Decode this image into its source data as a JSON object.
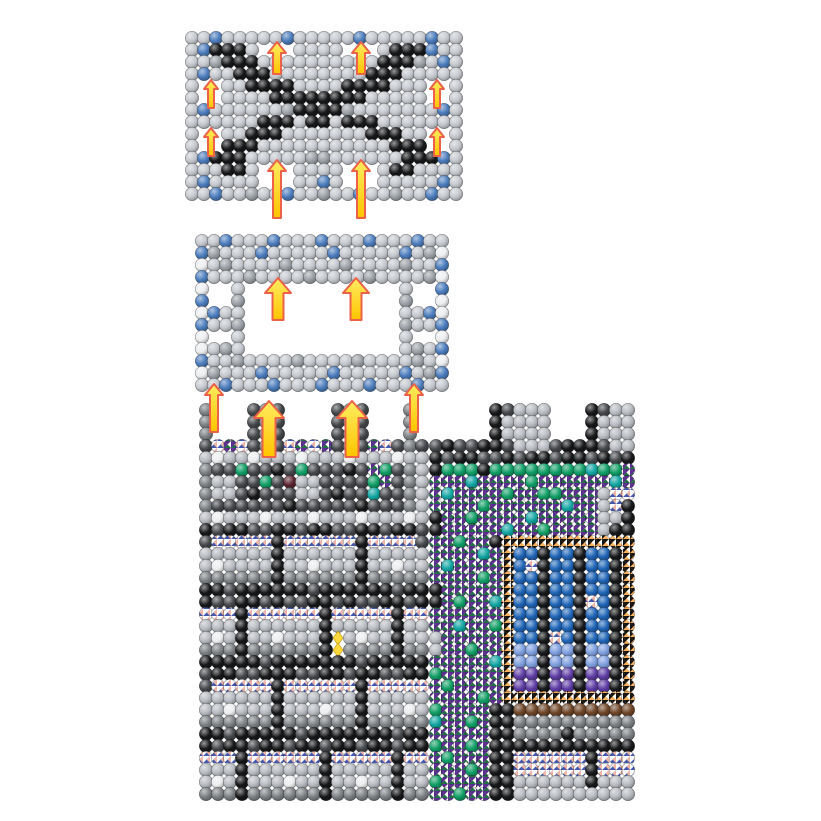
{
  "figure": {
    "kind": "molecular-assembly-exploded-view",
    "background": "#ffffff"
  },
  "scene": {
    "width": 821,
    "height": 821,
    "palette": {
      "S": "#c4c8ce",
      "W": "#eceef0",
      "G": "#9aa0a6",
      "L": "#b7bbc1",
      "M": "#7c8084",
      "D": "#44474b",
      "K": "#17181a",
      "B": "#4b7cbc",
      "E": "#0f9d64",
      "T": "#10a4a1",
      "U": "#1e64b6",
      "u": "#7e9ede",
      "R": "#5e3ca4",
      "N": "#6f4527",
      "x": "#5b2430"
    },
    "patterns": {
      "P": {
        "base": "#7f96da",
        "tris": [
          "#ffffff",
          "#f0b5a4",
          "#4458ac",
          "#ffffff"
        ]
      },
      "V": {
        "base": "#8cc63f",
        "tris": [
          "#5b2d91",
          "#ffffff",
          "#206f45",
          "#5b2d91"
        ]
      },
      "O": {
        "base": "#f68b1f",
        "tris": [
          "#141414",
          "#ffffff",
          "#f9b25f",
          "#141414"
        ]
      }
    },
    "panels": [
      {
        "name": "lid-lattice-panel",
        "x": 186,
        "y": 32,
        "bead": 12,
        "rows": [
          "SSBSSSSSBSSSSSBSSSSSBSS",
          "SBKKKS...SSSS...SKKKBSS",
          "SSGKKKSSSSSSSSSSKKKGSBS",
          "SBSSKKKSSSSSSSSKKKSSSSS",
          "S..SSKKKKSSSSKKKKSSS..S",
          "S..SSSSKKKKKKKKSSSSS..S",
          "SBSSSSSSGKKKKGSSSSSSSBS",
          "SSSSSSKKKSKKSKKKSSSSSSS",
          "S..SSKKKSSSSSSSKKKSS..S",
          "S..KKKSSSSSSSSSSSKKK..S",
          "SBKKKSSSSSGGSSSSSSKKKBS",
          "SSSKKS...SSSS...SKKSSSS",
          "SBSSSS...SSBS...SSSSSBS",
          "SSBSSGSSBSSGSSBSSGSSBSS"
        ]
      },
      {
        "name": "frame-panel",
        "x": 196,
        "y": 235,
        "bead": 12,
        "rows": [
          "SSBSSSBSSSBSSSBSSSBSS",
          "BGSSSBSSSSSBSSSSSBSGW",
          "WSGSSSSGSSSSGSSSSGSSB",
          "BSSSGSSSSGSSSSGSSSSGW",
          "W..S.............S..B",
          "B..G.............G..W",
          "WBSS.............SSBW",
          "BSSG.............GSSB",
          "W..S.............S..W",
          "WSGS.............SGSB",
          "BSSGSSSSGSSSSGSSSSGSW",
          "WGSSSBSSSSSBSSSSSBSGB",
          "SSBSSSBSSSBSSSBSSSBSS"
        ]
      },
      {
        "name": "box-wall-3d",
        "x": 200,
        "y": 404,
        "bead": 12,
        "rows": [
          "M...DMD....DMD...M.",
          "M...DMD....DMD...M.",
          "M...DMD....DMD...M.",
          "DPVPDMDPVPVDMDVPDMD",
          "LWLLWLLLWLLLWLLLWLL",
          "MDDEDDKDEDDDKDVEDML",
          "MLLDDEDxLLDDDDEVDML",
          "MLLDKDDDLLDKDDTDDML",
          "MDDDDDDKDDDDDKDDDML",
          "LWLLLWLLLWLLLWLLLWL",
          "KDKKDDKKDKKDDKKDKKD",
          "DPPPPPKPPPPPPKPPPPD",
          "LLLLLLKLLLLLLKLLLLL",
          "LWLLLLKLLWLLLKLLWLL",
          "MMMMMMKMMMMMMKMMMMM",
          "KKDKKKKKKDKKKKKKDKK",
          "KDDKKDKDDKKDKDDKKDK",
          "PPPKPPPPPPKPPPPPKPP",
          "LLLKLLLLLLKLLLLLKLL",
          "LWLKLLWLLLKYLWLLKLL",
          "MMMKMMMMMMKYMMMMKMM",
          "KKKKKDKKKKKKKDKKKKK",
          "DKKDDKKKDDKKDKKDDKK",
          "DPPPPPKPPPPPPKPPPPP",
          "LLLLLLKLLLLLLKLLLLL",
          "LLWLLLKLLLWLLKLLLWL",
          "MMMMMMKMMMMMMKMMMMM",
          "KKDKKKKKDKKKKKKKDKK",
          "KDKKDKKDKKDKKDKKDKK",
          "PPPKPPPPPPKPPPPPKPP",
          "LLLKLLLLLLKLLLLLKLL",
          "LWLKLLLWLLKLLWLLKLL",
          "MMMKMMMMMMKMMMMMKMM"
        ]
      },
      {
        "name": "cross-section-panel",
        "x": 430,
        "y": 404,
        "bead": 12,
        "rows": [
          ".....KDLLL...KDLL",
          ".....KLLLL...KLLL",
          ".....KLLLL...KLLL",
          "DKDDKKDLLLDKKKDLL",
          "KDKKDDKDKKDKKDKDK",
          "KEEEKEEEEEEEETEEV",
          "VVVTVVVVEVVVVVVTV",
          "VTVVVVEVVEEVVVLPP",
          "VVVVEVVVVVVTVVLPK",
          "KVVEVVVVTVVVVVLLK",
          "KVVVVVTVVEVVVVLKK",
          "VVEVVKOOOOOOOOOOO",
          "VVVVTVOUUKUUKUUKO",
          "VTVVVVOUPKUUKUUKO",
          "VVVVEVOUUKUUKUUKO",
          "KVVVVVOUUKUUKUUKO",
          "KVEVVTOUUKUUKPUKO",
          "VVVVVVOUUKUUKUUKO",
          "VVTVVEOUUKUUKUUKO",
          "LVVVVVOUUKPUKUUKO",
          "LVVEVVOuuKuuKuuKO",
          "VVVVVTOuuKuuKuuKO",
          "EVVVVVORRKRRKRRKO",
          "VEVVVVORRKRRKRRKO",
          "VVVVEVOOOOOOOOOOO",
          "EVVVVKKNNNNNNNNNN",
          "TVVEVKKMMMMMMMMMM",
          "VVVVVKKMMMMKMMMMM",
          "EVVEVKKKKKKKKKKKK",
          "VEVVVKKPPPPPPKPPP",
          "VVVEVKKPPPPPPKPPP",
          "EVVVVKKLLLLLLKLLL",
          "VVEVVKKLLLLLLLLLL"
        ]
      }
    ],
    "arrows": {
      "fill_top": "#ffec60",
      "fill_bottom": "#ffc400",
      "stroke": "#ed6148",
      "sizes": {
        "xsmall": {
          "head_w": 14,
          "head_h": 9,
          "stem_w": 6
        },
        "small": {
          "head_w": 18,
          "head_h": 11,
          "stem_w": 8
        },
        "medium": {
          "head_w": 26,
          "head_h": 15,
          "stem_w": 11
        },
        "large": {
          "head_w": 30,
          "head_h": 17,
          "stem_w": 13
        }
      },
      "items": [
        {
          "cx": 277,
          "tip_y": 42,
          "len": 32,
          "size": "small"
        },
        {
          "cx": 361,
          "tip_y": 42,
          "len": 32,
          "size": "small"
        },
        {
          "cx": 211,
          "tip_y": 80,
          "len": 28,
          "size": "xsmall"
        },
        {
          "cx": 437,
          "tip_y": 80,
          "len": 28,
          "size": "xsmall"
        },
        {
          "cx": 211,
          "tip_y": 128,
          "len": 28,
          "size": "xsmall"
        },
        {
          "cx": 437,
          "tip_y": 128,
          "len": 28,
          "size": "xsmall"
        },
        {
          "cx": 277,
          "tip_y": 160,
          "len": 58,
          "size": "small"
        },
        {
          "cx": 361,
          "tip_y": 160,
          "len": 58,
          "size": "small"
        },
        {
          "cx": 278,
          "tip_y": 278,
          "len": 42,
          "size": "medium"
        },
        {
          "cx": 356,
          "tip_y": 278,
          "len": 42,
          "size": "medium"
        },
        {
          "cx": 214,
          "tip_y": 384,
          "len": 48,
          "size": "small"
        },
        {
          "cx": 269,
          "tip_y": 401,
          "len": 56,
          "size": "large"
        },
        {
          "cx": 352,
          "tip_y": 401,
          "len": 56,
          "size": "large"
        },
        {
          "cx": 414,
          "tip_y": 384,
          "len": 48,
          "size": "small"
        }
      ]
    }
  }
}
